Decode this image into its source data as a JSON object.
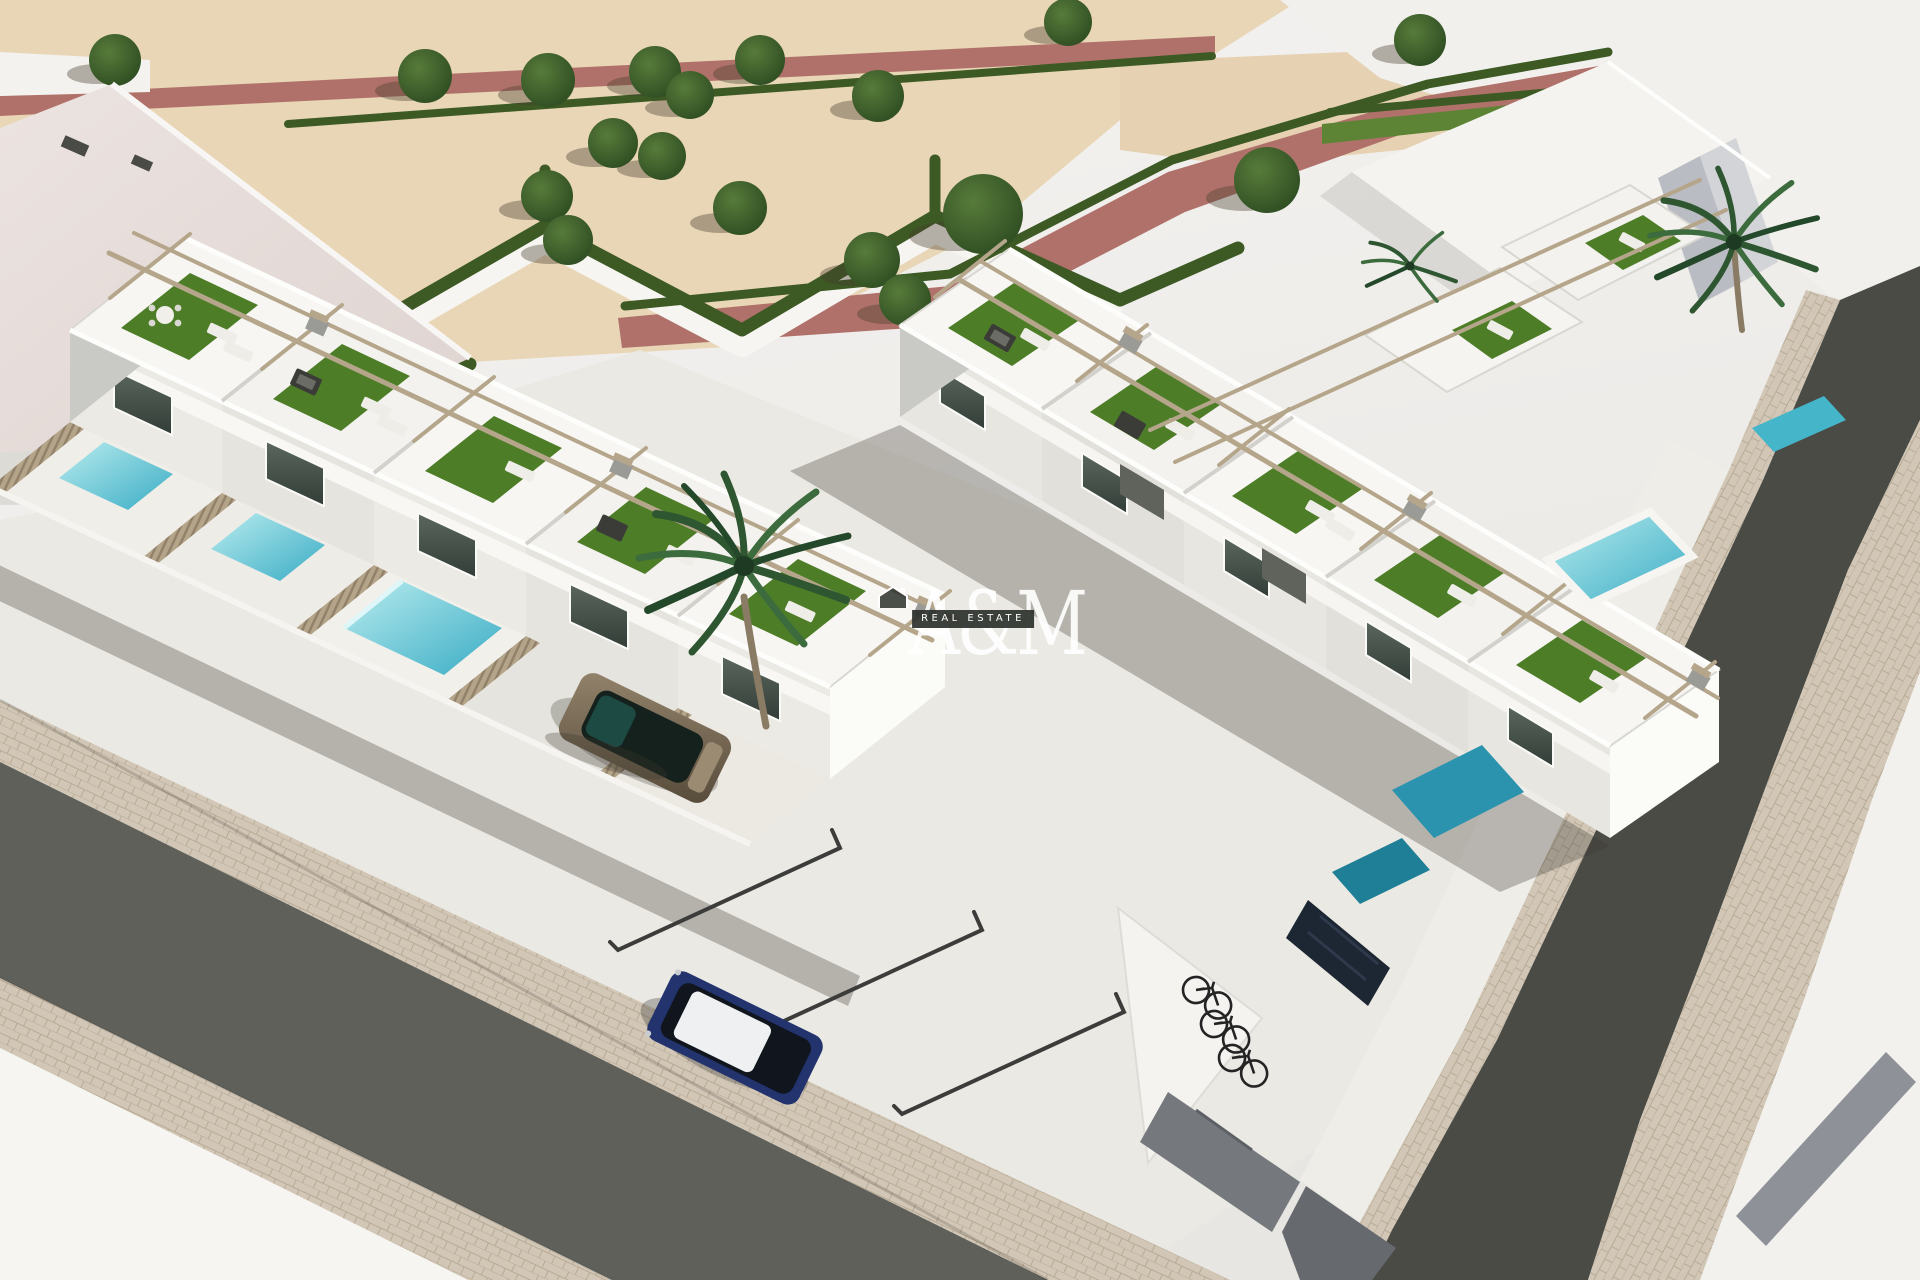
{
  "image": {
    "type": "natural-image",
    "subtype": "3d-architectural-render",
    "description": "Aerial 3D rendering of a modern white townhouse development with rooftop terraces, artificial turf, sun loungers, pergolas, private plunge pools, a landscaped park with zigzag hedges and trees, asphalt streets with cobblestone sidewalks, two parked cars and a bicycle rack",
    "view": "aerial three-quarter perspective"
  },
  "watermark": {
    "brand": "A&M",
    "tagline": "REAL ESTATE",
    "icon": "house-outline-icon"
  },
  "scene": {
    "park": {
      "ground": "sand gravel",
      "paths": [
        "red walkway",
        "white walkway"
      ],
      "hedges": "trimmed zigzag hedges",
      "tree_count": 18
    },
    "buildings": {
      "rows": 2,
      "style": "modern white townhouses",
      "features": [
        "rooftop terraces",
        "artificial turf",
        "sun loungers",
        "outdoor lounge furniture",
        "pergolas",
        "balconies",
        "private pools",
        "wood slat fences",
        "roof chimney boxes"
      ]
    },
    "vehicles": {
      "cars": [
        {
          "color": "bronze",
          "position": "driveway"
        },
        {
          "color": "dark blue",
          "roof": "white",
          "position": "parking bay"
        }
      ],
      "bicycle_count": 3
    },
    "streets": {
      "left_road": "asphalt with cobble sidewalks",
      "right_road": "curving asphalt street",
      "corner": "light paved corner with access ramp"
    },
    "vegetation": {
      "palm_count": 3
    }
  },
  "colors": {
    "bg_top": "#f3f2f0",
    "bg_bottom": "#e7e5e1",
    "sand": "#e9d6b6",
    "sand_dark": "#dcc49e",
    "path_red": "#b0716a",
    "path_white": "#f7f5f1",
    "hedge": "#3d5a25",
    "tree": "#3a5a2a",
    "turf": "#4e7d28",
    "wall_white": "#f6f5f2",
    "wall_shade": "#dcdbd6",
    "glass": "#4f5a53",
    "pergola": "#b5a68b",
    "wood": "#b4a489",
    "pool_light": "#a8e4ea",
    "pool_mid": "#45b5ca",
    "pool_deep": "#2b93ad",
    "pool_teal": "#1f7f96",
    "concrete": "#ebe9e3",
    "asphalt_left": "#60605a",
    "asphalt_right": "#4b4b46",
    "cobble": "#d2c7b6",
    "car_bronze": "#8a7963",
    "car_blue": "#22336d",
    "car_roof": "#eef0f2",
    "bike": "#242424",
    "shadow": "rgba(55,52,45,0.30)",
    "watermark_band": "#2e332e",
    "watermark_text": "#ffffff"
  }
}
